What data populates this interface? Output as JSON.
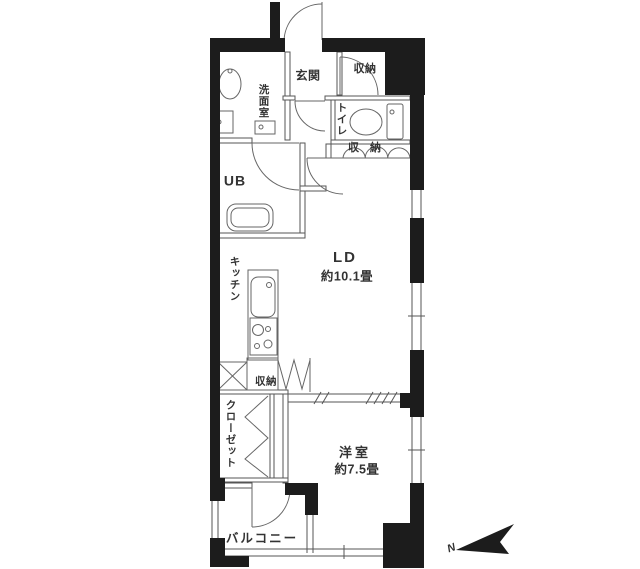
{
  "floorplan": {
    "labels": {
      "entrance": "玄関",
      "storage_entrance": "収納",
      "washroom": "洗面室",
      "toilet": "トイレ",
      "storage_hall": "収納",
      "unit_bath": "UB",
      "kitchen": "キッチン",
      "living_dining_name": "LD",
      "living_dining_size": "約10.1畳",
      "storage_kitchen": "収納",
      "closet": "クローゼット",
      "bedroom_name": "洋室",
      "bedroom_size": "約7.5畳",
      "balcony": "バルコニー"
    },
    "compass": {
      "label": "N"
    },
    "colors": {
      "wall": "#1c1c1c",
      "line": "#555555",
      "text": "#333333",
      "background": "#ffffff"
    }
  }
}
